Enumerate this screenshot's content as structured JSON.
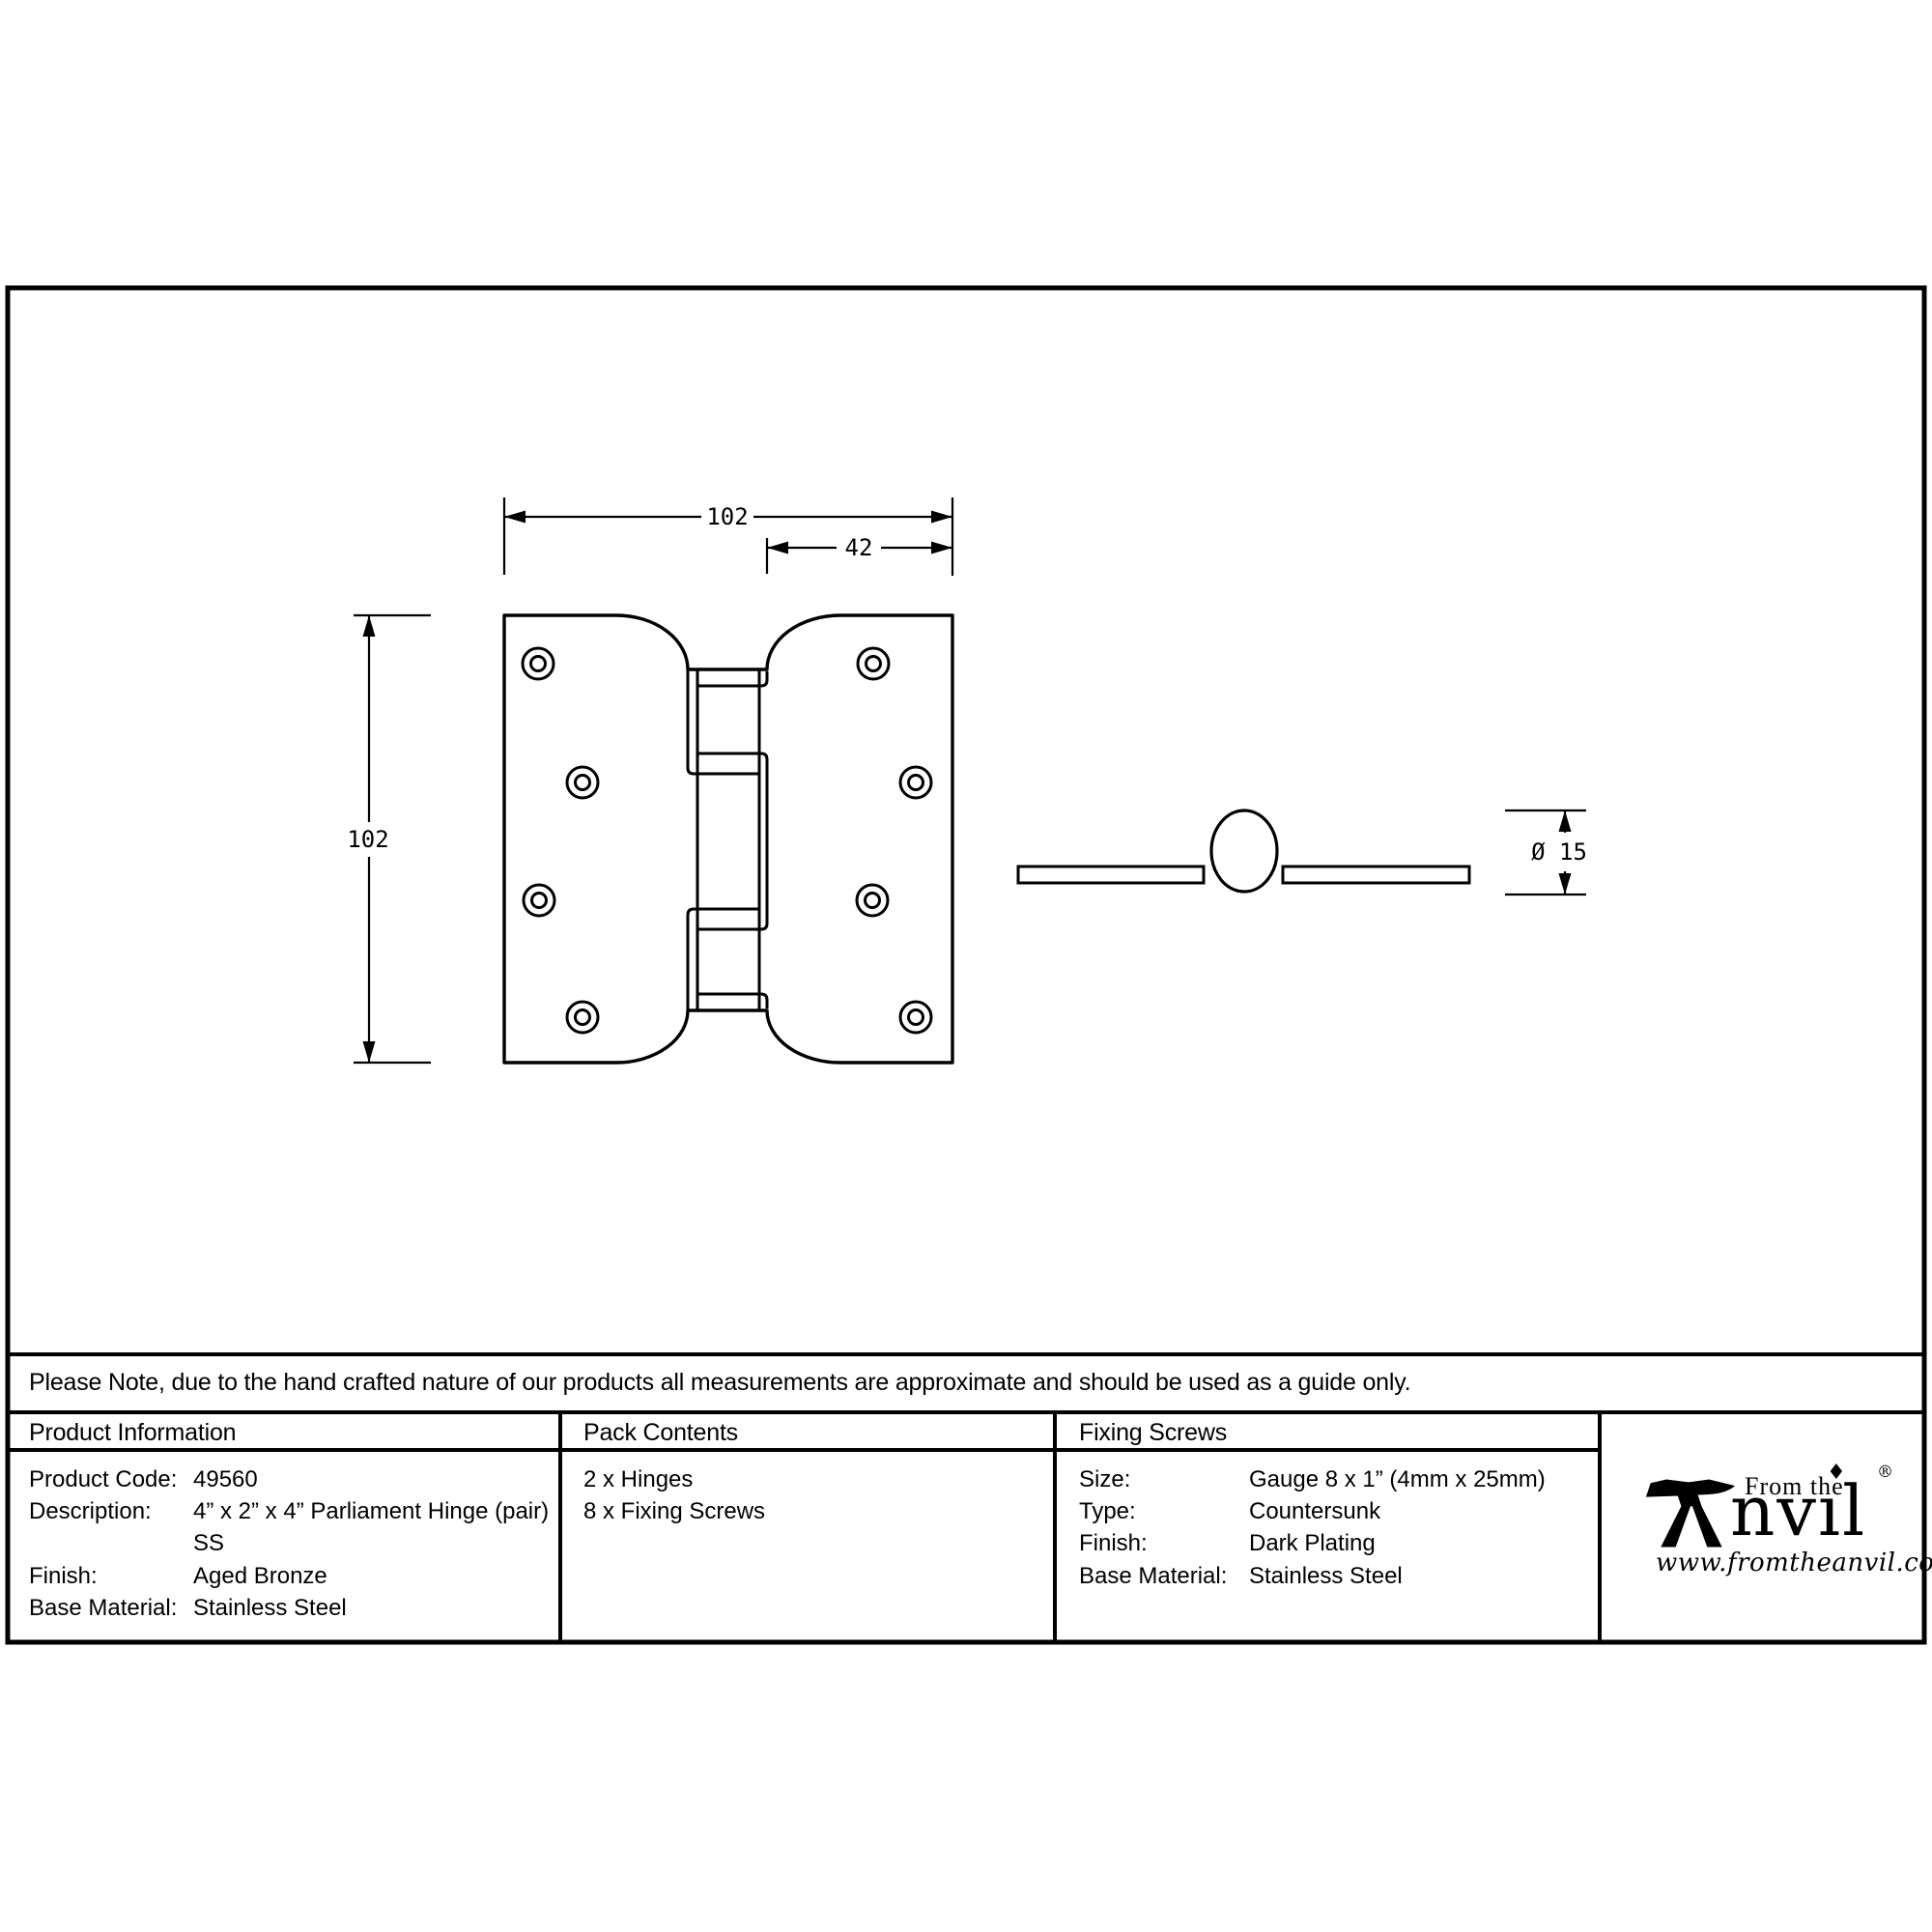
{
  "note": "Please Note, due to the hand crafted nature of our products all measurements are approximate and should be used as a guide only.",
  "drawing": {
    "front_view": {
      "width_label": "102",
      "offset_label": "42",
      "height_label": "102"
    },
    "side_view": {
      "diameter_label": "Ø 15"
    }
  },
  "table": {
    "product_information": {
      "header": "Product Information",
      "rows": [
        {
          "label": "Product Code:",
          "value": "49560"
        },
        {
          "label": "Description:",
          "value": "4” x 2” x 4” Parliament Hinge (pair)"
        },
        {
          "label": "",
          "value": "SS"
        },
        {
          "label": "Finish:",
          "value": "Aged Bronze"
        },
        {
          "label": "Base Material:",
          "value": "Stainless Steel"
        }
      ]
    },
    "pack_contents": {
      "header": "Pack Contents",
      "items": [
        "2 x Hinges",
        "8 x Fixing Screws"
      ]
    },
    "fixing_screws": {
      "header": "Fixing Screws",
      "rows": [
        {
          "label": "Size:",
          "value": "Gauge 8 x 1” (4mm x 25mm)"
        },
        {
          "label": "Type:",
          "value": "Countersunk"
        },
        {
          "label": "Finish:",
          "value": "Dark Plating"
        },
        {
          "label": "Base Material:",
          "value": "Stainless Steel"
        }
      ]
    }
  },
  "logo": {
    "tagline": "From the",
    "brand_text": "nvıl",
    "tittle": "♦",
    "registered": "®",
    "url": "www.fromtheanvil.co.uk"
  },
  "colors": {
    "line": "#000000",
    "background": "#ffffff"
  }
}
